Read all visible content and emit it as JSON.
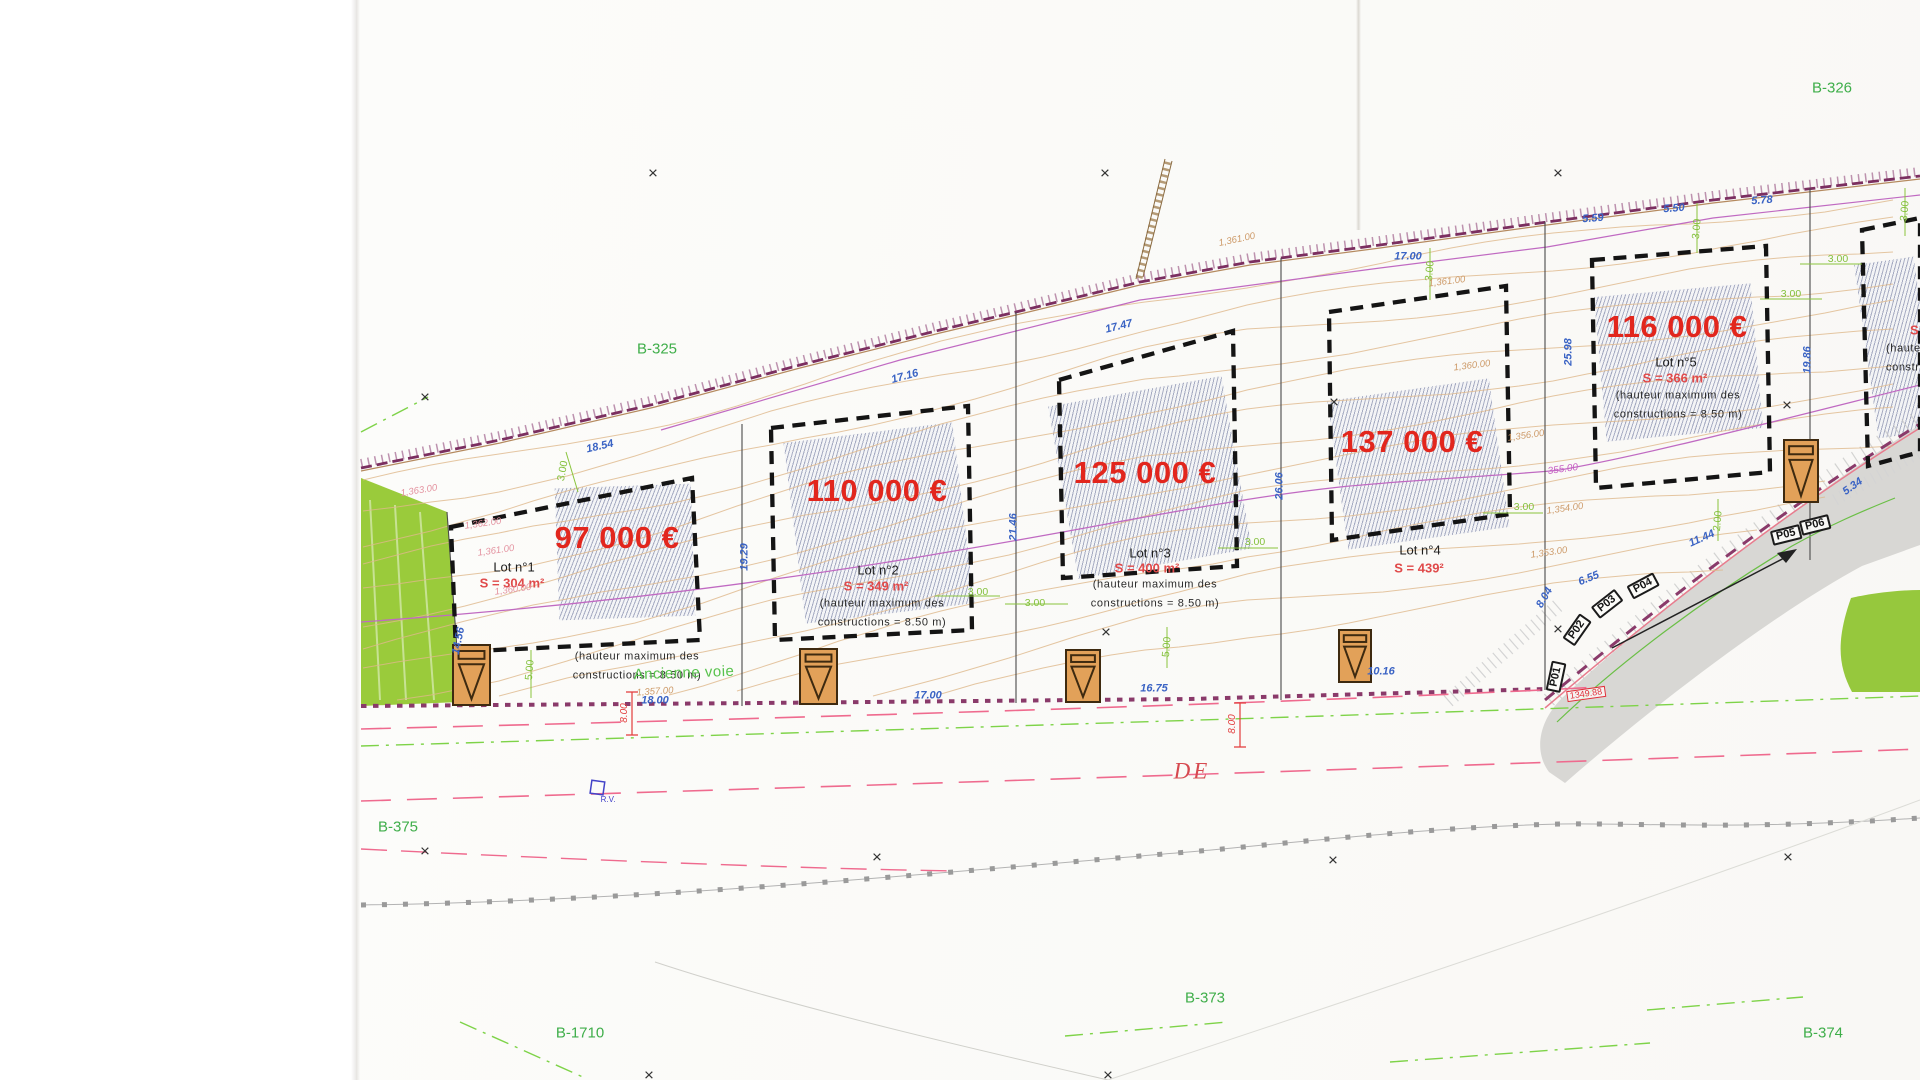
{
  "colors": {
    "price_red": "#e2261d",
    "area_red": "#e04a4a",
    "parcel_green": "#3fae4a",
    "dim_blue": "#3a63c4",
    "dim_green": "#84c13d",
    "contour_tan": "#dfb88b",
    "boundary_purple": "#7b2f60",
    "road_gray": "#d8d7d4",
    "grass_green": "#96c83d"
  },
  "lots": [
    {
      "price": "97 000 €",
      "name": "Lot n°1",
      "area": "S = 304 m²",
      "note": "(hauteur maximum des\nconstructions = 8.50 m)"
    },
    {
      "price": "110 000 €",
      "name": "Lot n°2",
      "area": "S = 349 m²",
      "note": "(hauteur maximum des\nconstructions = 8.50 m)"
    },
    {
      "price": "125 000 €",
      "name": "Lot n°3",
      "area": "S = 400 m²",
      "note": "(hauteur maximum des\nconstructions = 8.50 m)"
    },
    {
      "price": "137 000 €",
      "name": "Lot n°4",
      "area": "S = 439²",
      "note": ""
    },
    {
      "price": "116 000 €",
      "name": "Lot n°5",
      "area": "S = 366 m²",
      "note": "(hauteur maximum des\nconstructions = 8.50 m)"
    },
    {
      "price": "",
      "name": "",
      "area": "S =",
      "note": "(hauteur maximum des\nconstructions = 8.50 m)"
    }
  ],
  "labels": [
    {
      "t": "17.00",
      "x": 1408,
      "y": 257,
      "r": 0,
      "c": "blue"
    },
    {
      "t": "5.59",
      "x": 1593,
      "y": 219,
      "r": -4,
      "c": "blue"
    },
    {
      "t": "5.50",
      "x": 1674,
      "y": 209,
      "r": -4,
      "c": "blue"
    },
    {
      "t": "5.78",
      "x": 1762,
      "y": 201,
      "r": -4,
      "c": "blue"
    },
    {
      "t": "18.54",
      "x": 600,
      "y": 447,
      "r": -13,
      "c": "blue"
    },
    {
      "t": "17.16",
      "x": 905,
      "y": 377,
      "r": -15,
      "c": "blue"
    },
    {
      "t": "17.47",
      "x": 1119,
      "y": 327,
      "r": -14,
      "c": "blue"
    },
    {
      "t": "19.29",
      "x": 745,
      "y": 557,
      "r": -90,
      "c": "blue"
    },
    {
      "t": "21.46",
      "x": 1014,
      "y": 527,
      "r": -90,
      "c": "blue"
    },
    {
      "t": "26.06",
      "x": 1280,
      "y": 486,
      "r": -90,
      "c": "blue"
    },
    {
      "t": "25.98",
      "x": 1569,
      "y": 352,
      "r": -90,
      "c": "blue"
    },
    {
      "t": "19.86",
      "x": 1808,
      "y": 360,
      "r": -90,
      "c": "blue"
    },
    {
      "t": "14.56",
      "x": 459,
      "y": 641,
      "r": -78,
      "c": "blue"
    },
    {
      "t": "18.00",
      "x": 655,
      "y": 701,
      "r": 0,
      "c": "blue"
    },
    {
      "t": "17.00",
      "x": 928,
      "y": 696,
      "r": 0,
      "c": "blue"
    },
    {
      "t": "16.75",
      "x": 1154,
      "y": 689,
      "r": 0,
      "c": "blue"
    },
    {
      "t": "10.16",
      "x": 1381,
      "y": 672,
      "r": 0,
      "c": "blue"
    },
    {
      "t": "11.44",
      "x": 1702,
      "y": 539,
      "r": -24,
      "c": "blue"
    },
    {
      "t": "6.55",
      "x": 1589,
      "y": 579,
      "r": -22,
      "c": "blue"
    },
    {
      "t": "8.04",
      "x": 1545,
      "y": 598,
      "r": -60,
      "c": "blue"
    },
    {
      "t": "5.34",
      "x": 1853,
      "y": 487,
      "r": -35,
      "c": "blue"
    },
    {
      "t": "3.00",
      "x": 563,
      "y": 471,
      "r": -80,
      "c": "green"
    },
    {
      "t": "3.00",
      "x": 978,
      "y": 592,
      "r": 0,
      "c": "green"
    },
    {
      "t": "3.00",
      "x": 1035,
      "y": 603,
      "r": 0,
      "c": "green"
    },
    {
      "t": "3.00",
      "x": 1255,
      "y": 542,
      "r": 0,
      "c": "green"
    },
    {
      "t": "3.00",
      "x": 1524,
      "y": 507,
      "r": 0,
      "c": "green"
    },
    {
      "t": "3.00",
      "x": 1838,
      "y": 259,
      "r": 0,
      "c": "green"
    },
    {
      "t": "3.00",
      "x": 1791,
      "y": 294,
      "r": 0,
      "c": "green"
    },
    {
      "t": "3.00",
      "x": 1430,
      "y": 271,
      "r": -85,
      "c": "green"
    },
    {
      "t": "3.00",
      "x": 1697,
      "y": 229,
      "r": -85,
      "c": "green"
    },
    {
      "t": "3.00",
      "x": 1905,
      "y": 211,
      "r": -85,
      "c": "green"
    },
    {
      "t": "5.00",
      "x": 530,
      "y": 670,
      "r": -85,
      "c": "green"
    },
    {
      "t": "5.00",
      "x": 1167,
      "y": 647,
      "r": -85,
      "c": "green"
    },
    {
      "t": "2.00",
      "x": 1718,
      "y": 521,
      "r": -85,
      "c": "green"
    },
    {
      "t": "1,361.00",
      "x": 1447,
      "y": 282,
      "r": -7,
      "c": "tan"
    },
    {
      "t": "1,361.00",
      "x": 1237,
      "y": 240,
      "r": -12,
      "c": "tan"
    },
    {
      "t": "1,360.00",
      "x": 1472,
      "y": 366,
      "r": -7,
      "c": "tan"
    },
    {
      "t": "1,356.00",
      "x": 1526,
      "y": 436,
      "r": -8,
      "c": "tan"
    },
    {
      "t": "1,354.00",
      "x": 1565,
      "y": 509,
      "r": -8,
      "c": "tan"
    },
    {
      "t": "1,353.00",
      "x": 1549,
      "y": 553,
      "r": -8,
      "c": "tan"
    },
    {
      "t": "1,357.00",
      "x": 655,
      "y": 692,
      "r": -4,
      "c": "tan"
    },
    {
      "t": "1,363.00",
      "x": 419,
      "y": 491,
      "r": -9,
      "c": "pink"
    },
    {
      "t": "1,362.00",
      "x": 483,
      "y": 524,
      "r": -8,
      "c": "pink"
    },
    {
      "t": "1,361.00",
      "x": 496,
      "y": 551,
      "r": -8,
      "c": "pink"
    },
    {
      "t": "1,360.00",
      "x": 513,
      "y": 590,
      "r": -8,
      "c": "pink"
    },
    {
      "t": "355.00",
      "x": 1563,
      "y": 470,
      "r": -8,
      "c": "mag"
    },
    {
      "t": "8.00",
      "x": 625,
      "y": 713,
      "r": -90,
      "c": "red"
    },
    {
      "t": "8.00",
      "x": 1233,
      "y": 724,
      "r": -90,
      "c": "red"
    },
    {
      "t": "P01",
      "x": 1556,
      "y": 677,
      "r": -78,
      "c": "pbox"
    },
    {
      "t": "P02",
      "x": 1577,
      "y": 630,
      "r": -55,
      "c": "pbox"
    },
    {
      "t": "P03",
      "x": 1607,
      "y": 604,
      "r": -38,
      "c": "pbox"
    },
    {
      "t": "P04",
      "x": 1643,
      "y": 586,
      "r": -28,
      "c": "pbox"
    },
    {
      "t": "P05",
      "x": 1786,
      "y": 535,
      "r": -14,
      "c": "pbox"
    },
    {
      "t": "P06",
      "x": 1815,
      "y": 525,
      "r": -14,
      "c": "pbox"
    },
    {
      "t": "1349.88",
      "x": 1586,
      "y": 694,
      "r": -8,
      "c": "redbox"
    },
    {
      "t": "R.V.",
      "x": 608,
      "y": 800,
      "r": 0,
      "c": "rv"
    },
    {
      "t": "DE",
      "x": 1192,
      "y": 771,
      "r": 0,
      "c": "de"
    },
    {
      "t": "Ancienne voie",
      "x": 684,
      "y": 673,
      "r": -2,
      "c": "voie"
    },
    {
      "t": "B-325",
      "x": 657,
      "y": 349,
      "r": 0,
      "c": "parcel"
    },
    {
      "t": "B-326",
      "x": 1832,
      "y": 88,
      "r": 0,
      "c": "parcel"
    },
    {
      "t": "B-375",
      "x": 398,
      "y": 827,
      "r": 0,
      "c": "parcel"
    },
    {
      "t": "B-1710",
      "x": 580,
      "y": 1033,
      "r": 0,
      "c": "parcel"
    },
    {
      "t": "B-373",
      "x": 1205,
      "y": 998,
      "r": 0,
      "c": "parcel"
    },
    {
      "t": "B-374",
      "x": 1823,
      "y": 1033,
      "r": 0,
      "c": "parcel"
    },
    {
      "t": "×",
      "x": 653,
      "y": 173,
      "r": 0,
      "c": "cross"
    },
    {
      "t": "×",
      "x": 1105,
      "y": 173,
      "r": 0,
      "c": "cross"
    },
    {
      "t": "×",
      "x": 1558,
      "y": 173,
      "r": 0,
      "c": "cross"
    },
    {
      "t": "×",
      "x": 425,
      "y": 397,
      "r": 0,
      "c": "cross"
    },
    {
      "t": "×",
      "x": 1334,
      "y": 402,
      "r": 0,
      "c": "cross"
    },
    {
      "t": "×",
      "x": 1787,
      "y": 405,
      "r": 0,
      "c": "cross"
    },
    {
      "t": "×",
      "x": 1106,
      "y": 632,
      "r": 0,
      "c": "cross"
    },
    {
      "t": "×",
      "x": 1558,
      "y": 629,
      "r": 0,
      "c": "cross"
    },
    {
      "t": "×",
      "x": 425,
      "y": 851,
      "r": 0,
      "c": "cross"
    },
    {
      "t": "×",
      "x": 877,
      "y": 857,
      "r": 0,
      "c": "cross"
    },
    {
      "t": "×",
      "x": 1333,
      "y": 860,
      "r": 0,
      "c": "cross"
    },
    {
      "t": "×",
      "x": 1788,
      "y": 857,
      "r": 0,
      "c": "cross"
    },
    {
      "t": "×",
      "x": 649,
      "y": 1075,
      "r": 0,
      "c": "cross"
    },
    {
      "t": "×",
      "x": 1108,
      "y": 1075,
      "r": 0,
      "c": "cross"
    }
  ],
  "symbols": [
    [
      453,
      645,
      37,
      60
    ],
    [
      800,
      649,
      37,
      55
    ],
    [
      1066,
      650,
      34,
      52
    ],
    [
      1339,
      630,
      32,
      52
    ],
    [
      1784,
      440,
      34,
      62
    ]
  ]
}
